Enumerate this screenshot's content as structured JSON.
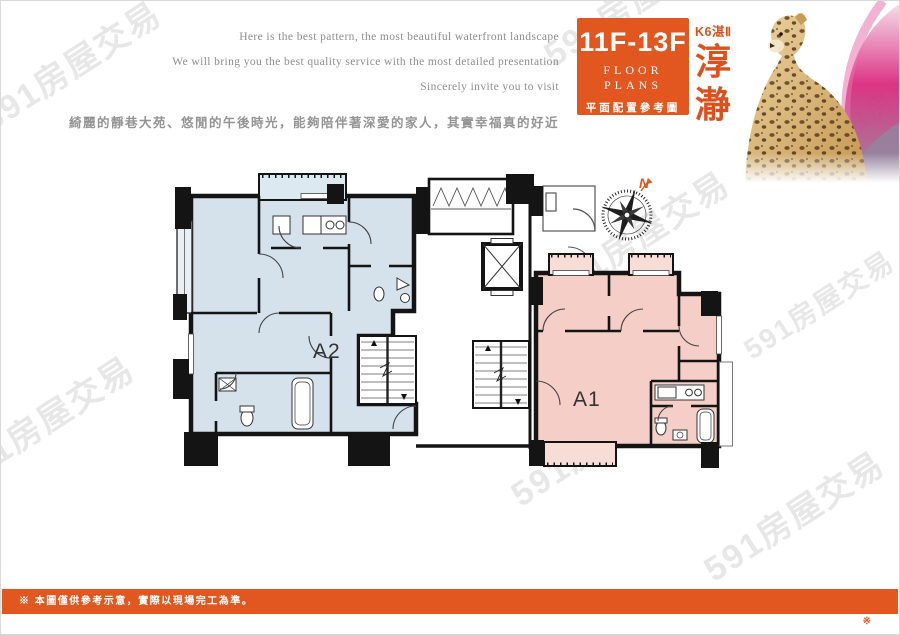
{
  "watermark": {
    "text": "591房屋交易"
  },
  "header": {
    "slogan_en": [
      "Here is the best pattern, the most beautiful waterfront landscape",
      "We will bring you the best quality service with the most detailed presentation",
      "Sincerely invite you to visit"
    ],
    "slogan_zh": "綺麗的靜巷大苑、悠閒的午後時光，能夠陪伴著深愛的家人，其實幸福真的好近",
    "floor_badge": {
      "floors": "11F-13F",
      "title_en": "FLOOR PLANS",
      "title_zh": "平面配置參考圖",
      "bg": "#e2561f"
    },
    "project": {
      "series": "K6湛Ⅱ",
      "name_chars": [
        "淳",
        "瀞"
      ]
    }
  },
  "plan": {
    "units": [
      {
        "id": "A2",
        "label": "A2",
        "fill": "#d5e2ec"
      },
      {
        "id": "A1",
        "label": "A1",
        "fill": "#f5cfc7"
      }
    ],
    "compass": {
      "north_label": "N",
      "color": "#e2561f"
    },
    "wall_color": "#141414"
  },
  "footer": {
    "disclaimer": "※ 本圖僅供參考示意，實際以現場完工為準。",
    "bar_color": "#e2561f",
    "corner_mark": "※"
  }
}
